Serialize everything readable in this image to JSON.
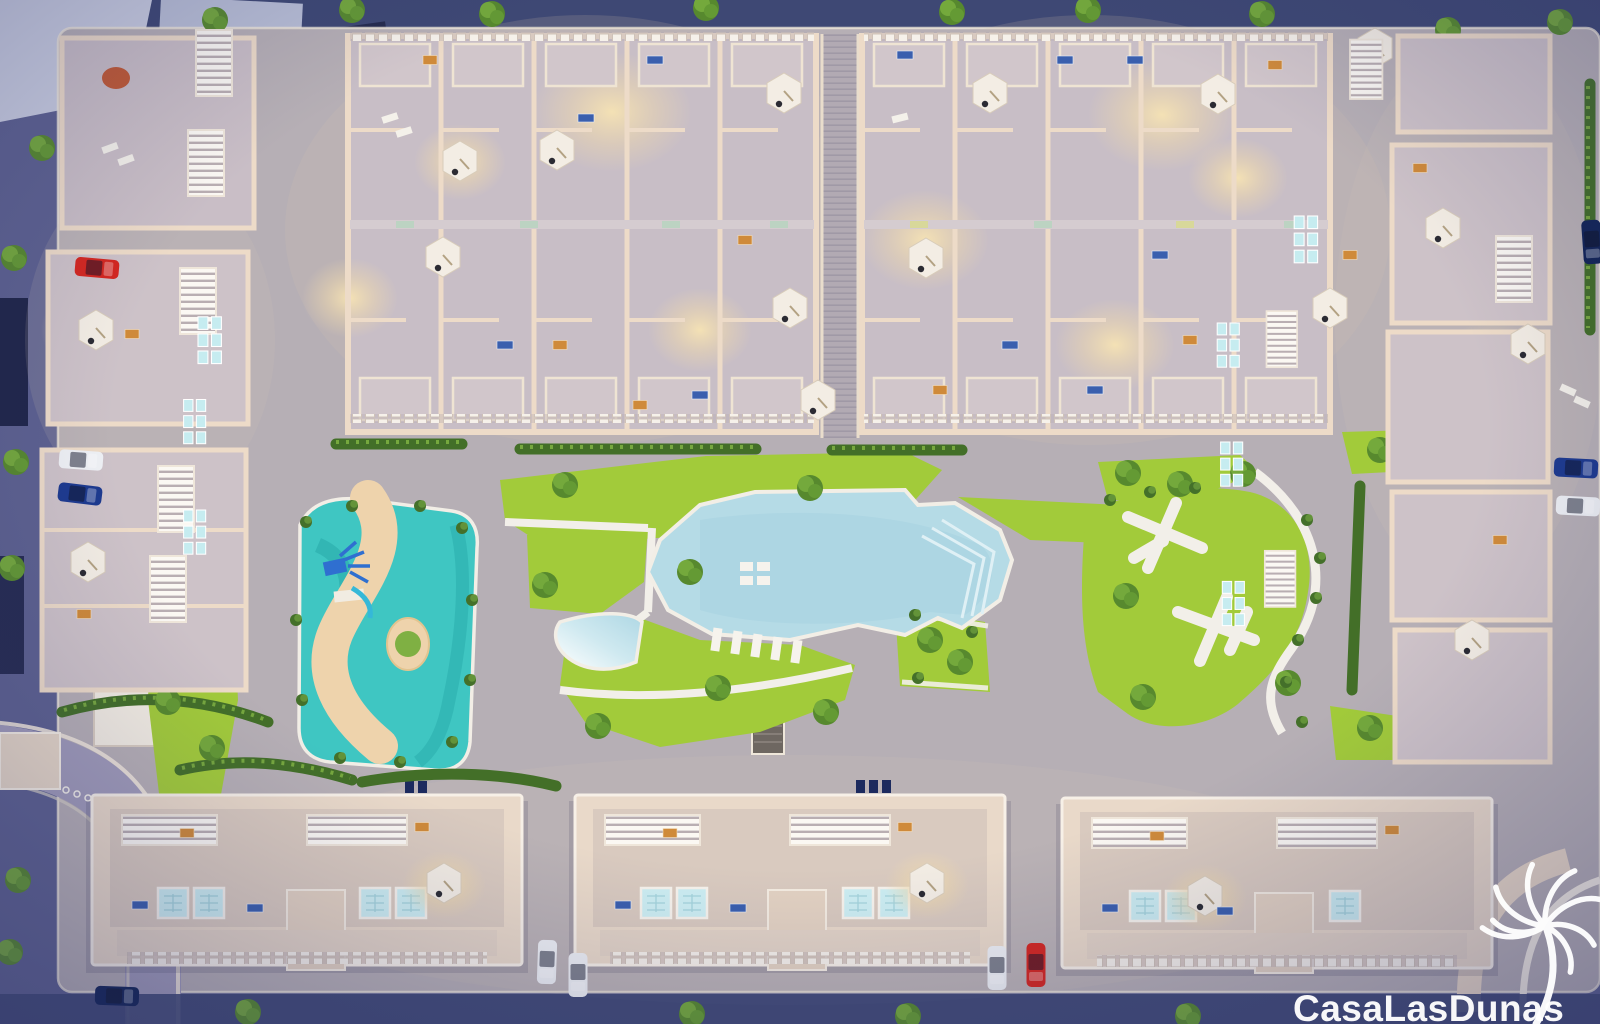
{
  "meta": {
    "description": "Dusk aerial 3D render of the Casa Las Dunas residential resort masterplan: two townhouse blocks at top, perimeter apartment buildings left and right, three long apartment blocks at bottom, central amenity area with lagoon pool, beach-entry pool, kids splash playground with winding sand path, lawns, pergola park and parked cars on surrounding streets."
  },
  "logo": {
    "text": "CasaLasDunas",
    "icon": "palm-tree-icon",
    "color": "#ffffff"
  },
  "palette": {
    "dusk_outer": "#5d6190",
    "dusk_deep": "#3e4874",
    "pavement": "#b6afb5",
    "road": "#a09bb9",
    "curb": "#efe7da",
    "building_wall": "#eddbc8",
    "building_floor": "#c8bec6",
    "building_body": "#e9d9c9",
    "roof_white": "#f8f4ee",
    "window_glass": "#c6ecf0",
    "lawn": "#a2cb3a",
    "hedge": "#436f28",
    "pool_water": "#b5dbe6",
    "splash_water": "#3fc6c2",
    "splash_sand": "#eed3ac",
    "stairs_dark": "#6e6761",
    "glow_warm": "#f6e3b4",
    "car_red": "#d42720",
    "car_blue": "#1d3a8f",
    "car_white": "#eef0f4",
    "car_navy": "#122457",
    "furniture_orange": "#cf8a3a",
    "furniture_blue": "#3a5fae"
  },
  "scene": {
    "features": [
      "lagoon-pool",
      "beach-entry-pool",
      "kids-splash-playground",
      "pergola-park",
      "lawns",
      "townhouse-block-nw",
      "townhouse-block-ne",
      "perimeter-buildings-west",
      "perimeter-buildings-east",
      "apartment-building-sw",
      "apartment-building-s",
      "apartment-building-se",
      "parked-cars",
      "street-trees",
      "rooftop-parasols",
      "plunge-pools"
    ],
    "parked_car_colors": [
      "red",
      "white",
      "blue",
      "navy"
    ],
    "time_of_day": "dusk"
  }
}
